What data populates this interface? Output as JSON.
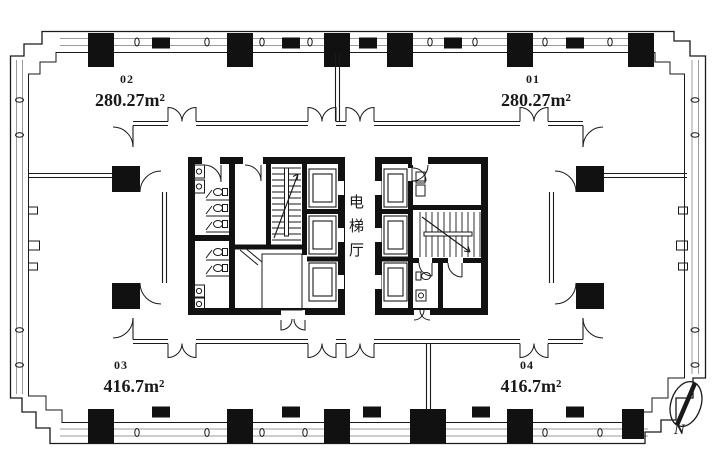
{
  "plan": {
    "units": [
      {
        "number": "02",
        "area": "280.27m²"
      },
      {
        "number": "01",
        "area": "280.27m²"
      },
      {
        "number": "03",
        "area": "416.7m²"
      },
      {
        "number": "04",
        "area": "416.7m²"
      }
    ],
    "core": {
      "elevator_hall": "电梯厅"
    },
    "compass": {
      "label": "N"
    },
    "colors": {
      "ink": "#1a1a1a",
      "wall": "#111111",
      "glazing": "#9b9b9b"
    }
  }
}
